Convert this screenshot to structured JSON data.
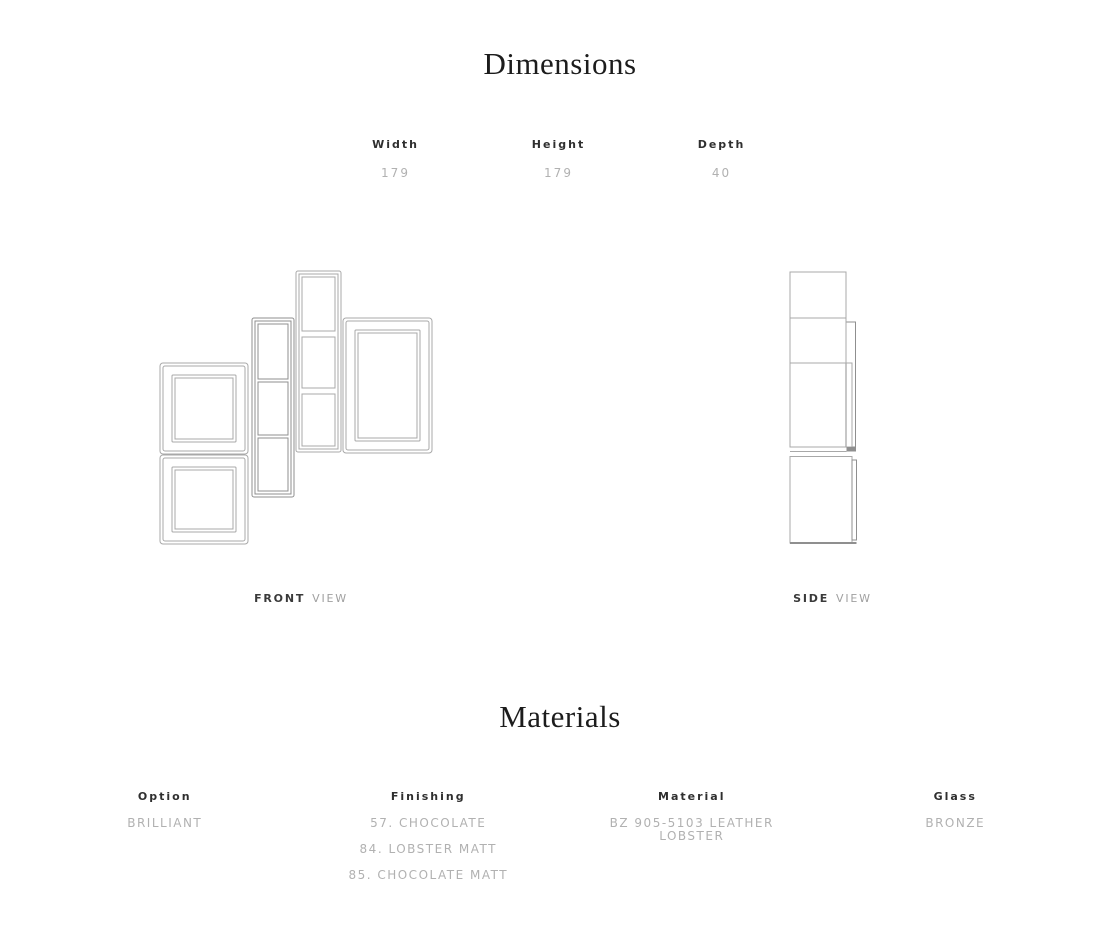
{
  "theme": {
    "background": "#ffffff",
    "heading_color": "#1c1c1c",
    "label_color": "#2f2f2f",
    "value_color": "#b1b1b1",
    "caption_secondary_color": "#a0a0a0",
    "line_color": "#a8a8a8",
    "line_color_dark": "#8f8f8f"
  },
  "dimensions_section": {
    "title": "Dimensions",
    "specs": [
      {
        "label": "Width",
        "value": "179"
      },
      {
        "label": "Height",
        "value": "179"
      },
      {
        "label": "Depth",
        "value": "40"
      }
    ],
    "front_view": {
      "label": "FRONT",
      "type": "VIEW"
    },
    "side_view": {
      "label": "SIDE",
      "type": "VIEW"
    }
  },
  "materials_section": {
    "title": "Materials",
    "columns": [
      {
        "header": "Option",
        "values": [
          "BRILLIANT"
        ]
      },
      {
        "header": "Finishing",
        "values": [
          "57. CHOCOLATE",
          "84. LOBSTER MATT",
          "85. CHOCOLATE MATT"
        ]
      },
      {
        "header": "Material",
        "values": [
          "BZ 905-5103 LEATHER LOBSTER"
        ]
      },
      {
        "header": "Glass",
        "values": [
          "BRONZE"
        ]
      }
    ]
  }
}
